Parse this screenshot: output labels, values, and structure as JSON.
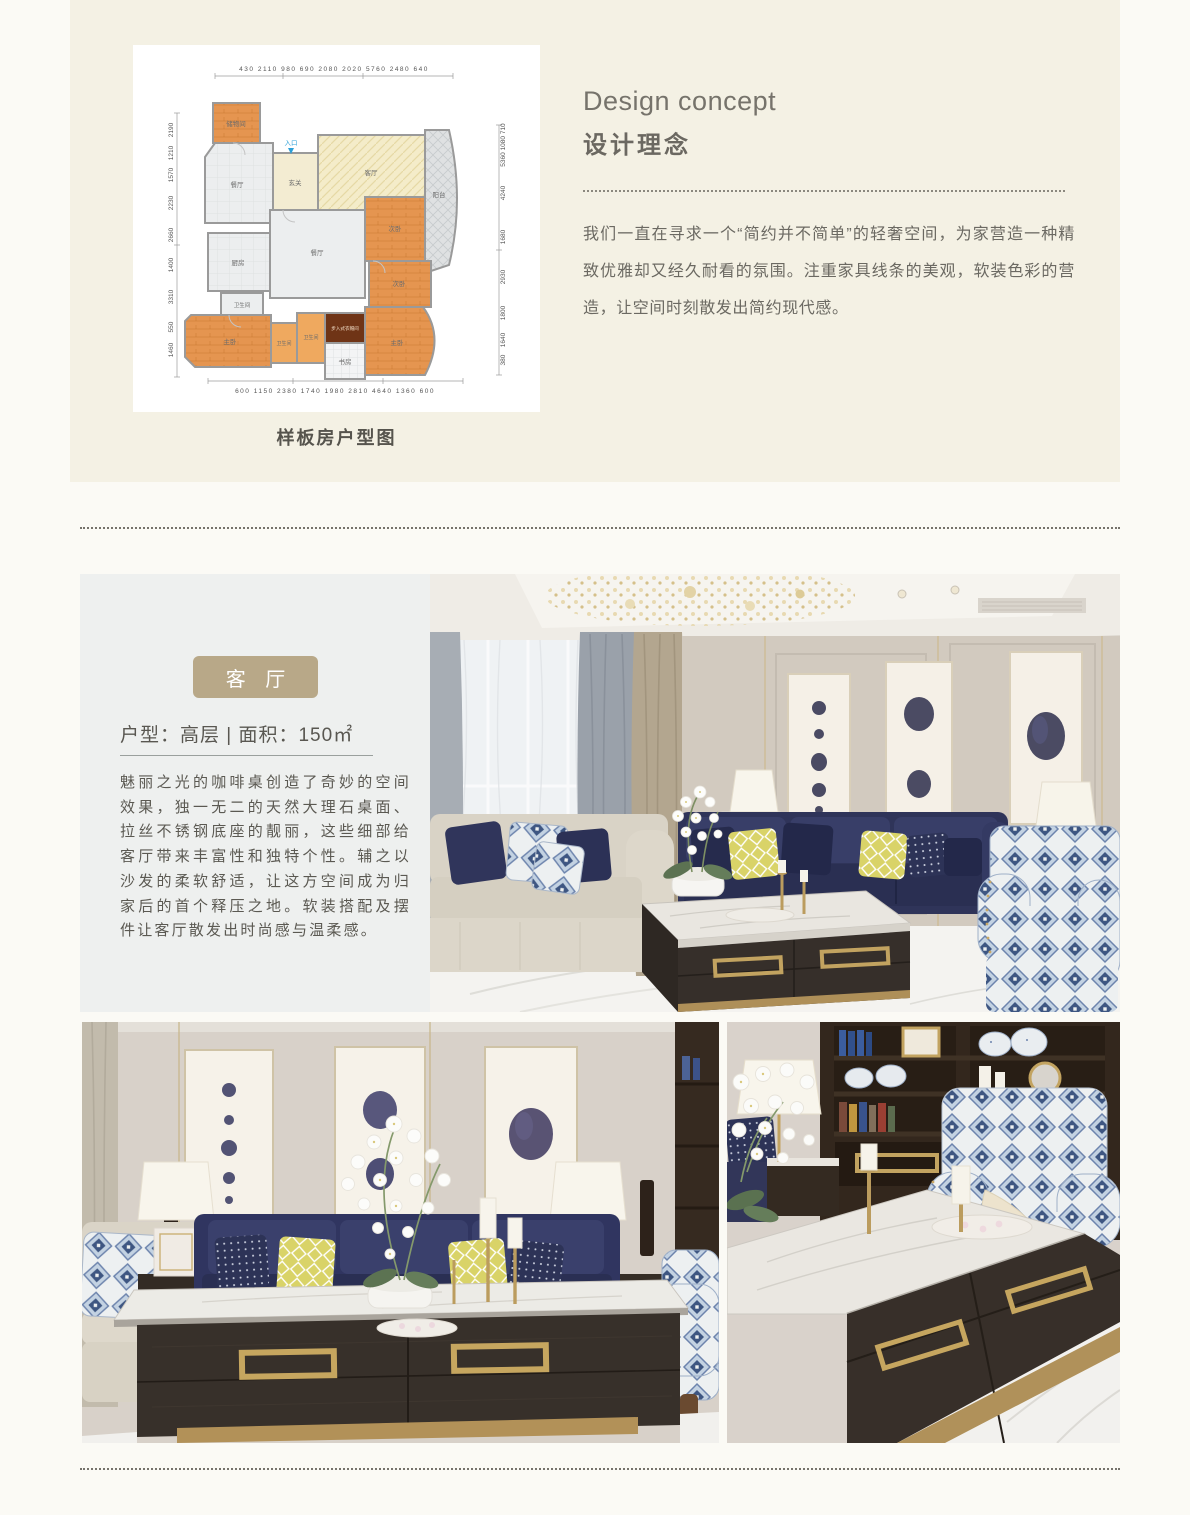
{
  "top_section": {
    "floorplan": {
      "caption": "样板房户型图",
      "entrance_label": "入口",
      "dims": {
        "top": "430 2110 980 690 2080 2020 5760 2480 640",
        "bottom": "600 1150 2380 1740 1980 2810 4640 1360 600",
        "left": [
          "2190",
          "1210",
          "1570",
          "2230",
          "2660",
          "1400",
          "3310",
          "550",
          "1460"
        ],
        "right": [
          "5360 1080 710",
          "4240",
          "1680",
          "2930",
          "1800",
          "1640",
          "380"
        ]
      },
      "rooms": [
        "储物间",
        "餐厅",
        "玄关",
        "客厅",
        "阳台",
        "厨房",
        "餐厅",
        "次卧",
        "次卧",
        "卫生间",
        "主卧",
        "卫生间",
        "卫生间",
        "步入式衣帽间",
        "书房",
        "主卧"
      ]
    },
    "design_concept": {
      "title_en": "Design concept",
      "title_zh": "设计理念",
      "body": "我们一直在寻求一个“简约并不简单”的轻奢空间，为家营造一种精致优雅却又经久耐看的氛围。注重家具线条的美观，软装色彩的营造，让空间时刻散发出简约现代感。"
    }
  },
  "living_section": {
    "badge_label": "客 厅",
    "spec_line": "户型：高层 | 面积：150㎡",
    "body": "魅丽之光的咖啡桌创造了奇妙的空间效果，独一无二的天然大理石桌面、拉丝不锈钢底座的靓丽，这些细部给客厅带来丰富性和独特个性。辅之以沙发的柔软舒适，让这方空间成为归家后的首个释压之地。软装搭配及摆件让客厅散发出时尚感与温柔感。"
  },
  "colors": {
    "page_bg": "#fbfaf5",
    "panel_bg": "#f4f1e4",
    "card_bg": "#ffffff",
    "section_bg": "#eef0ef",
    "badge_bg": "#b8a888",
    "badge_text": "#ffffff",
    "heading_text": "#76736b",
    "body_text": "#6b6962",
    "accent_gold": "#c2a360",
    "navy": "#2e3357",
    "floorplan_orange": "#e59550",
    "floorplan_cream": "#f4ecc9"
  }
}
